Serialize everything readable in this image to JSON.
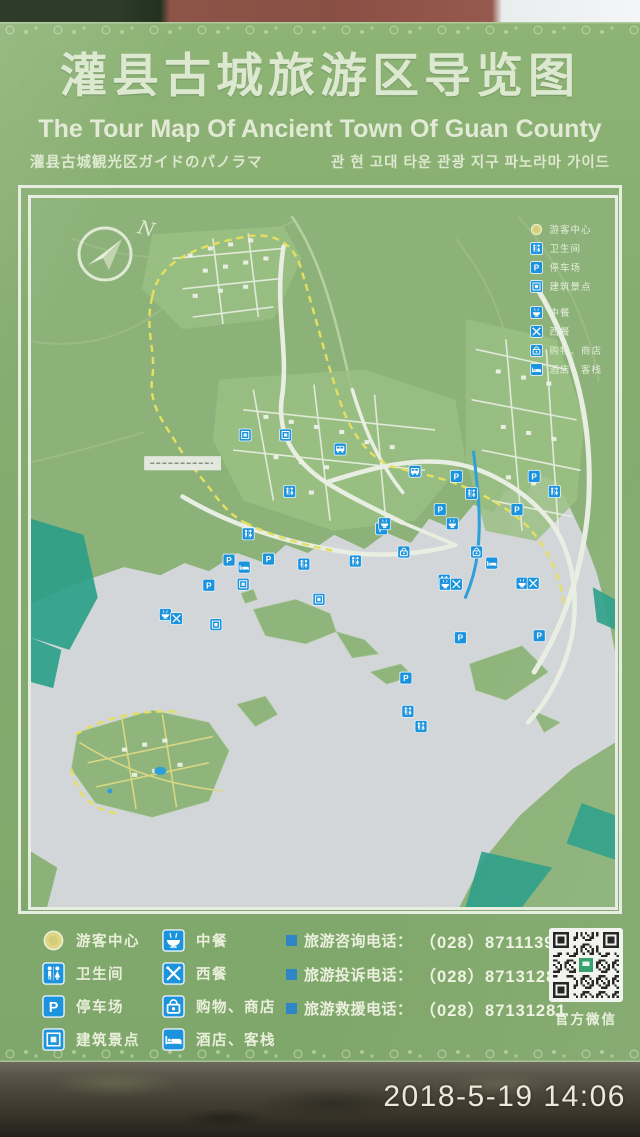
{
  "header": {
    "title_zh": "灌县古城旅游区导览图",
    "title_en": "The Tour Map Of Ancient Town Of Guan County",
    "subtitle_ja": "灌县古城観光区ガイドのパノラマ",
    "subtitle_ko": "관 현 고대 타운 관광 지구 파노라마 가이드"
  },
  "map": {
    "compass_label": "N",
    "legend": {
      "items": [
        {
          "icon": "visitor-center-icon",
          "label": "游客中心"
        },
        {
          "icon": "toilet-icon",
          "label": "卫生间"
        },
        {
          "icon": "parking-icon",
          "label": "停车场"
        },
        {
          "icon": "attraction-icon",
          "label": "建筑景点"
        },
        {
          "icon": "chinese-restaurant-icon",
          "label": "中餐"
        },
        {
          "icon": "western-restaurant-icon",
          "label": "西餐"
        },
        {
          "icon": "shop-icon",
          "label": "购物、商店"
        },
        {
          "icon": "hotel-icon",
          "label": "酒店、客栈"
        }
      ]
    },
    "markers": [
      {
        "type": "attraction",
        "x": 252,
        "y": 235
      },
      {
        "type": "attraction",
        "x": 212,
        "y": 235
      },
      {
        "type": "attraction",
        "x": 210,
        "y": 383
      },
      {
        "type": "attraction",
        "x": 285,
        "y": 398
      },
      {
        "type": "attraction",
        "x": 183,
        "y": 423
      },
      {
        "type": "toilet",
        "x": 256,
        "y": 291
      },
      {
        "type": "toilet",
        "x": 321,
        "y": 360
      },
      {
        "type": "toilet",
        "x": 215,
        "y": 333
      },
      {
        "type": "toilet",
        "x": 270,
        "y": 363
      },
      {
        "type": "toilet",
        "x": 518,
        "y": 291
      },
      {
        "type": "toilet",
        "x": 436,
        "y": 293
      },
      {
        "type": "toilet",
        "x": 409,
        "y": 379
      },
      {
        "type": "toilet",
        "x": 373,
        "y": 509
      },
      {
        "type": "toilet",
        "x": 386,
        "y": 524
      },
      {
        "type": "parking",
        "x": 235,
        "y": 358
      },
      {
        "type": "parking",
        "x": 347,
        "y": 328
      },
      {
        "type": "parking",
        "x": 498,
        "y": 276
      },
      {
        "type": "parking",
        "x": 481,
        "y": 309
      },
      {
        "type": "parking",
        "x": 421,
        "y": 276
      },
      {
        "type": "parking",
        "x": 405,
        "y": 309
      },
      {
        "type": "parking",
        "x": 196,
        "y": 359
      },
      {
        "type": "parking",
        "x": 176,
        "y": 384
      },
      {
        "type": "parking",
        "x": 425,
        "y": 436
      },
      {
        "type": "parking",
        "x": 371,
        "y": 476
      },
      {
        "type": "parking",
        "x": 503,
        "y": 434
      },
      {
        "type": "cn-restaurant",
        "x": 417,
        "y": 323
      },
      {
        "type": "cn-restaurant",
        "x": 350,
        "y": 323
      },
      {
        "type": "cn-restaurant",
        "x": 133,
        "y": 413
      },
      {
        "type": "cn-restaurant",
        "x": 410,
        "y": 383
      },
      {
        "type": "cn-restaurant",
        "x": 486,
        "y": 382
      },
      {
        "type": "w-restaurant",
        "x": 144,
        "y": 417
      },
      {
        "type": "w-restaurant",
        "x": 421,
        "y": 383
      },
      {
        "type": "w-restaurant",
        "x": 497,
        "y": 382
      },
      {
        "type": "shop",
        "x": 441,
        "y": 351
      },
      {
        "type": "shop",
        "x": 369,
        "y": 351
      },
      {
        "type": "hotel",
        "x": 456,
        "y": 362
      },
      {
        "type": "hotel",
        "x": 211,
        "y": 366
      },
      {
        "type": "bus",
        "x": 306,
        "y": 249
      },
      {
        "type": "bus",
        "x": 380,
        "y": 271
      }
    ]
  },
  "footer": {
    "contacts": [
      {
        "label": "旅游咨询电话：",
        "number": "（028）87111399"
      },
      {
        "label": "旅游投诉电话：",
        "number": "（028）87131281"
      },
      {
        "label": "旅游救援电话：",
        "number": "（028）87131281"
      }
    ],
    "wechat_label": "官方微信"
  },
  "photo": {
    "timestamp": "2018-5-19 14:06"
  },
  "colors": {
    "sign_green": "#86ac70",
    "map_green": "#8cb279",
    "river": "#d2d6d8",
    "road_white": "#e9eee3",
    "boundary_yellow": "#e4df62",
    "marker_blue": "#1c93dd",
    "forest_teal": "#2da089",
    "visitor_yellow": "#dcd685",
    "wall_red": "#8a4f44"
  }
}
